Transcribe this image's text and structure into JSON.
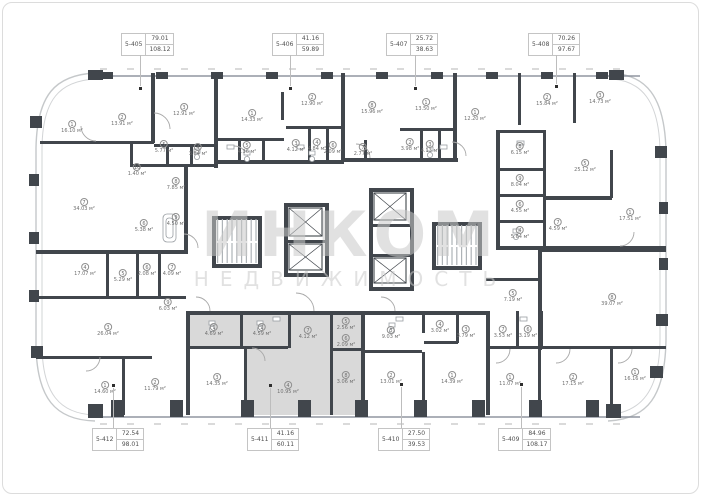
{
  "watermark": {
    "line1": "ИНКОМ",
    "line2": "НЕДВИЖИМОСТЬ"
  },
  "area_unit": "м²",
  "highlighted_unit": "5-411",
  "colors": {
    "wall": "#41464c",
    "highlight": "#d9d9d9",
    "leader": "#bdbdbd",
    "watermark": "#c9c9c9"
  },
  "units": [
    {
      "id": "5-405",
      "value_top": "79.01",
      "value_bottom": "108.12",
      "side": "top",
      "cx": 145,
      "lx": 140,
      "dot_y": 88
    },
    {
      "id": "5-406",
      "value_top": "41.16",
      "value_bottom": "59.89",
      "side": "top",
      "cx": 296,
      "lx": 290,
      "dot_y": 88
    },
    {
      "id": "5-407",
      "value_top": "25.72",
      "value_bottom": "38.63",
      "side": "top",
      "cx": 410,
      "lx": 415,
      "dot_y": 88
    },
    {
      "id": "5-408",
      "value_top": "70.26",
      "value_bottom": "97.67",
      "side": "top",
      "cx": 552,
      "lx": 556,
      "dot_y": 86
    },
    {
      "id": "5-412",
      "value_top": "72.54",
      "value_bottom": "98.01",
      "side": "bottom",
      "cx": 116,
      "lx": 113,
      "dot_y": 385
    },
    {
      "id": "5-411",
      "value_top": "41.16",
      "value_bottom": "60.11",
      "side": "bottom",
      "cx": 271,
      "lx": 270,
      "dot_y": 385
    },
    {
      "id": "5-410",
      "value_top": "27.50",
      "value_bottom": "39.53",
      "side": "bottom",
      "cx": 402,
      "lx": 401,
      "dot_y": 384
    },
    {
      "id": "5-409",
      "value_top": "84.96",
      "value_bottom": "108.17",
      "side": "bottom",
      "cx": 522,
      "lx": 521,
      "dot_y": 384
    }
  ],
  "rooms": [
    {
      "n": "1",
      "a": "16.10",
      "x": 72,
      "y": 127
    },
    {
      "n": "2",
      "a": "13.91",
      "x": 122,
      "y": 120
    },
    {
      "n": "3",
      "a": "12.91",
      "x": 184,
      "y": 110
    },
    {
      "n": "5",
      "a": "5.77",
      "x": 164,
      "y": 147
    },
    {
      "n": "4",
      "a": "3.84",
      "x": 198,
      "y": 150
    },
    {
      "n": "10",
      "a": "1.40",
      "x": 137,
      "y": 170
    },
    {
      "n": "8",
      "a": "7.85",
      "x": 176,
      "y": 184
    },
    {
      "n": "7",
      "a": "34.03",
      "x": 84,
      "y": 205
    },
    {
      "n": "6",
      "a": "5.38",
      "x": 144,
      "y": 226
    },
    {
      "n": "9",
      "a": "4.50",
      "x": 176,
      "y": 220
    },
    {
      "n": "1",
      "a": "14.33",
      "x": 252,
      "y": 116
    },
    {
      "n": "2",
      "a": "12.90",
      "x": 312,
      "y": 100
    },
    {
      "n": "3",
      "a": "4.12",
      "x": 296,
      "y": 146
    },
    {
      "n": "5",
      "a": "4.36",
      "x": 247,
      "y": 148
    },
    {
      "n": "4",
      "a": "4.84",
      "x": 317,
      "y": 145
    },
    {
      "n": "6",
      "a": "2.09",
      "x": 333,
      "y": 148
    },
    {
      "n": "8",
      "a": "15.96",
      "x": 372,
      "y": 108
    },
    {
      "n": "1",
      "a": "13.50",
      "x": 426,
      "y": 105
    },
    {
      "n": "7",
      "a": "2.77",
      "x": 363,
      "y": 150
    },
    {
      "n": "2",
      "a": "3.98",
      "x": 410,
      "y": 145
    },
    {
      "n": "3",
      "a": "4.13",
      "x": 430,
      "y": 147
    },
    {
      "n": "1",
      "a": "12.20",
      "x": 475,
      "y": 115
    },
    {
      "n": "2",
      "a": "15.84",
      "x": 547,
      "y": 100
    },
    {
      "n": "3",
      "a": "14.73",
      "x": 600,
      "y": 98
    },
    {
      "n": "8",
      "a": "6.15",
      "x": 520,
      "y": 149
    },
    {
      "n": "9",
      "a": "8.04",
      "x": 520,
      "y": 181
    },
    {
      "n": "6",
      "a": "4.55",
      "x": 520,
      "y": 207
    },
    {
      "n": "4",
      "a": "5.64",
      "x": 520,
      "y": 233
    },
    {
      "n": "7",
      "a": "4.59",
      "x": 558,
      "y": 225
    },
    {
      "n": "5",
      "a": "25.12",
      "x": 585,
      "y": 166
    },
    {
      "n": "1",
      "a": "17.51",
      "x": 630,
      "y": 215
    },
    {
      "n": "4",
      "a": "17.07",
      "x": 85,
      "y": 270
    },
    {
      "n": "5",
      "a": "5.29",
      "x": 123,
      "y": 276
    },
    {
      "n": "6",
      "a": "2.08",
      "x": 147,
      "y": 270
    },
    {
      "n": "7",
      "a": "4.09",
      "x": 172,
      "y": 270
    },
    {
      "n": "9",
      "a": "6.03",
      "x": 168,
      "y": 305
    },
    {
      "n": "3",
      "a": "26.04",
      "x": 108,
      "y": 330
    },
    {
      "n": "1",
      "a": "14.60",
      "x": 105,
      "y": 388
    },
    {
      "n": "2",
      "a": "11.79",
      "x": 155,
      "y": 385
    },
    {
      "n": "1",
      "a": "4.69",
      "x": 214,
      "y": 330
    },
    {
      "n": "2",
      "a": "4.59",
      "x": 262,
      "y": 330
    },
    {
      "n": "7",
      "a": "4.12",
      "x": 308,
      "y": 333
    },
    {
      "n": "3",
      "a": "14.35",
      "x": 217,
      "y": 380
    },
    {
      "n": "4",
      "a": "10.95",
      "x": 288,
      "y": 388
    },
    {
      "n": "5",
      "a": "2.56",
      "x": 346,
      "y": 324
    },
    {
      "n": "6",
      "a": "2.09",
      "x": 346,
      "y": 341
    },
    {
      "n": "8",
      "a": "3.06",
      "x": 346,
      "y": 378
    },
    {
      "n": "3",
      "a": "9.03",
      "x": 391,
      "y": 333
    },
    {
      "n": "4",
      "a": "3.02",
      "x": 440,
      "y": 327
    },
    {
      "n": "2",
      "a": "13.01",
      "x": 391,
      "y": 378
    },
    {
      "n": "1",
      "a": "14.39",
      "x": 452,
      "y": 378
    },
    {
      "n": "5",
      "a": "7.19",
      "x": 513,
      "y": 296
    },
    {
      "n": "8",
      "a": "39.07",
      "x": 612,
      "y": 300
    },
    {
      "n": "3",
      "a": "3.79",
      "x": 466,
      "y": 332
    },
    {
      "n": "7",
      "a": "3.53",
      "x": 503,
      "y": 332
    },
    {
      "n": "6",
      "a": "3.19",
      "x": 528,
      "y": 332
    },
    {
      "n": "1",
      "a": "11.07",
      "x": 510,
      "y": 380
    },
    {
      "n": "2",
      "a": "17.15",
      "x": 573,
      "y": 380
    },
    {
      "n": "1",
      "a": "16.16",
      "x": 635,
      "y": 375
    }
  ]
}
